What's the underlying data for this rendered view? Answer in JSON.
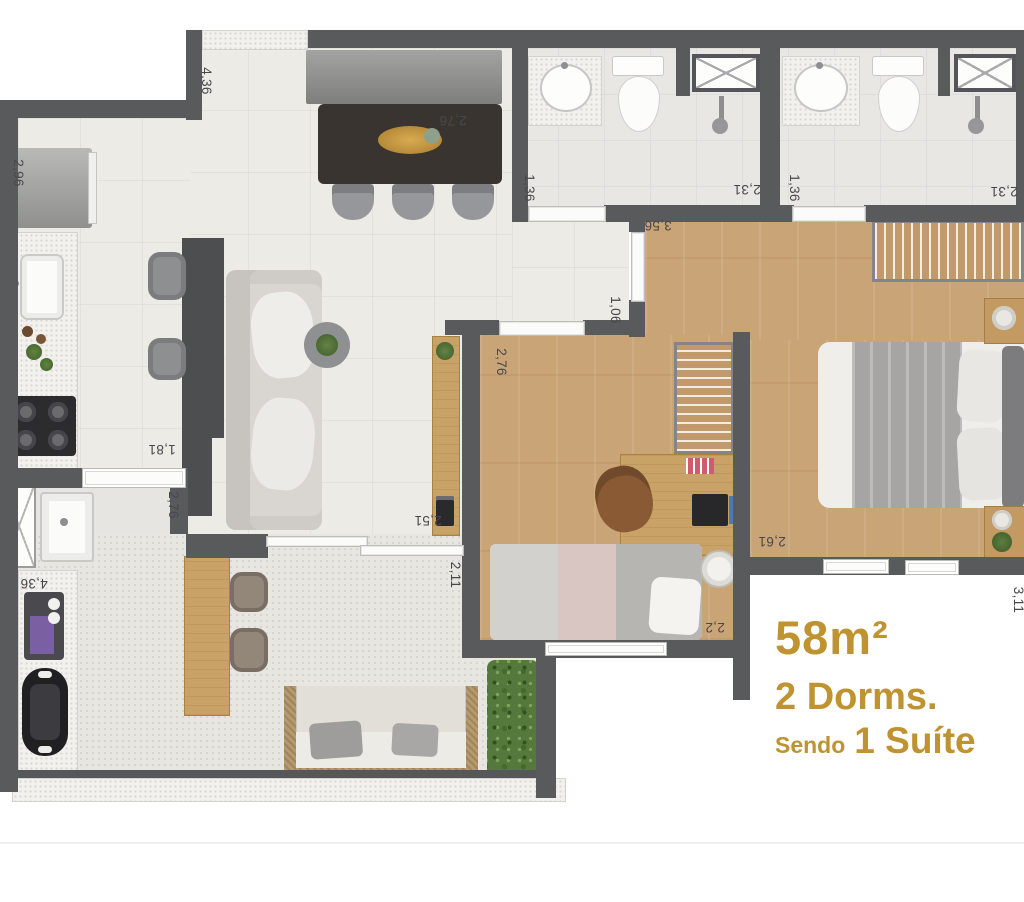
{
  "title_block": {
    "area": "58m²",
    "dorms": "2 Dorms.",
    "suite_prefix": "Sendo",
    "suite_name": "1 Suíte"
  },
  "colors": {
    "accent_gold": "#bf9331",
    "wall": "#595a5c",
    "wood_floor": "#c9a477",
    "tile_floor": "#edebe6",
    "dimension_text": "#48484a"
  },
  "dimensions": [
    {
      "label": "4,36",
      "location": "entry-wall"
    },
    {
      "label": "2,76",
      "location": "dining-top"
    },
    {
      "label": "2,96",
      "location": "kitchen-fridge"
    },
    {
      "label": "1,36",
      "location": "bathroom-1-left"
    },
    {
      "label": "2,31",
      "location": "bathroom-1-right"
    },
    {
      "label": "1,36",
      "location": "bathroom-2-left"
    },
    {
      "label": "2,31",
      "location": "bathroom-2-right"
    },
    {
      "label": "3,56",
      "location": "suite-entry"
    },
    {
      "label": "1,06",
      "location": "hallway"
    },
    {
      "label": "2,76",
      "location": "bedroom-2-top"
    },
    {
      "label": "2,51",
      "location": "living-room"
    },
    {
      "label": "2,11",
      "location": "bedroom-2-left"
    },
    {
      "label": "2,2",
      "location": "bedroom-2-bottom"
    },
    {
      "label": "2,61",
      "location": "suite-bottom"
    },
    {
      "label": "1,81",
      "location": "kitchen-pass-through"
    },
    {
      "label": "2,76",
      "location": "service-area"
    },
    {
      "label": "4,36",
      "location": "balcony-counter"
    },
    {
      "label": "3,11",
      "location": "right-edge-partial"
    }
  ]
}
